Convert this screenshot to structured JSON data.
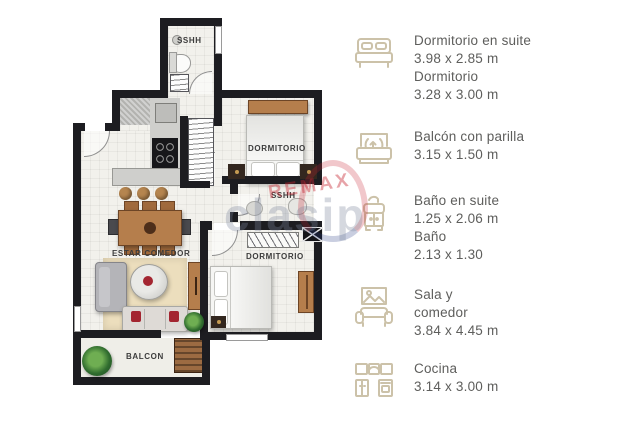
{
  "plan": {
    "rooms": {
      "bathroom_top": "SSHH",
      "bedroom_top": "DORMITORIO",
      "bathroom_ensuite": "SSHH",
      "bedroom_bottom": "DORMITORIO",
      "living_dining": "ESTAR COMEDOR",
      "balcony": "BALCON"
    }
  },
  "watermark": {
    "brand": "REMAX",
    "site": "clasip"
  },
  "legend": {
    "items": [
      {
        "icon": "double-bed-icon",
        "lines": [
          "Dormitorio en suite",
          "3.98 x 2.85 m",
          "Dormitorio",
          "3.28 x 3.00 m"
        ]
      },
      {
        "icon": "balcony-planter-icon",
        "lines": [
          "Balcón con parilla",
          "3.15 x 1.50 m"
        ]
      },
      {
        "icon": "washbasin-icon",
        "lines": [
          "Baño en suite",
          "1.25 x 2.06 m",
          "Baño",
          "2.13 x 1.30"
        ]
      },
      {
        "icon": "sofa-picture-icon",
        "lines": [
          "Sala y",
          "comedor",
          "3.84 x 4.45 m"
        ]
      },
      {
        "icon": "kitchen-cabinets-icon",
        "lines": [
          "Cocina",
          "3.14 x 3.00 m"
        ]
      }
    ]
  },
  "colors": {
    "wall": "#1d1d21",
    "floor": "#f2f1ec",
    "legend_text": "#5e5e5c",
    "legend_icon": "#ccc2a9",
    "wood": "#b57e4c",
    "watermark_red": "#c62330"
  }
}
